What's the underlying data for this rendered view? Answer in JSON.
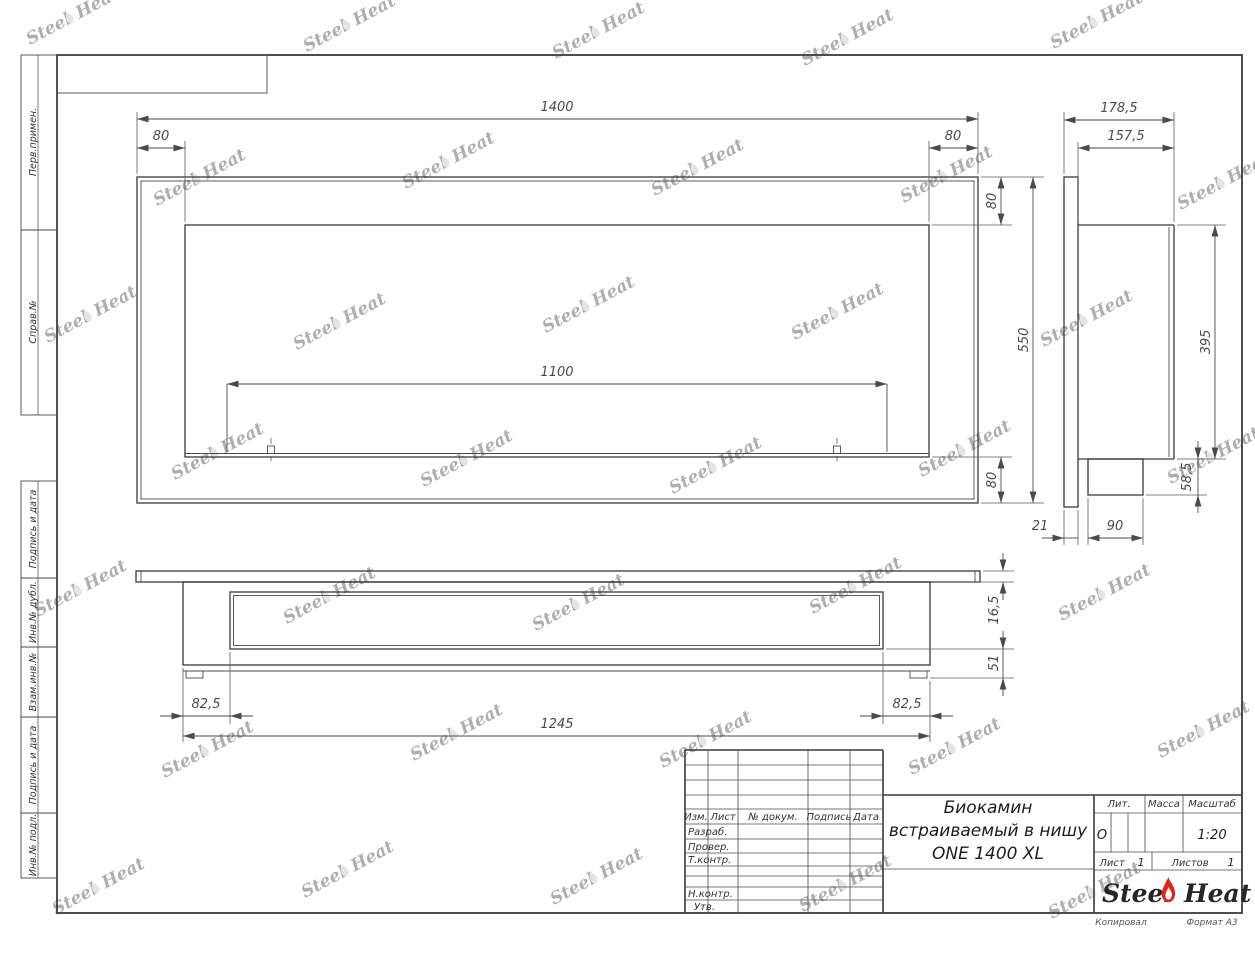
{
  "watermark": {
    "steel": "Steel",
    "heat": "Heat"
  },
  "sidebar": {
    "labels": [
      "Перв.примен.",
      "Справ.№",
      "Подпись и дата",
      "Инв.№ дубл.",
      "Взам.инв.№",
      "Подпись и дата",
      "Инв.№ подл."
    ]
  },
  "dims": {
    "front": {
      "total_width": "1400",
      "left_margin": "80",
      "right_margin": "80",
      "opening_width": "1100",
      "top_margin": "80",
      "total_height": "550",
      "bottom_margin": "80"
    },
    "side": {
      "total_depth": "178,5",
      "inner_depth": "157,5",
      "inner_height": "395",
      "burner_drop": "58,5",
      "flange_offset": "21",
      "burner_depth": "90"
    },
    "plan": {
      "flange_thickness": "16,5",
      "foot_drop": "51",
      "left_offset": "82,5",
      "right_offset": "82,5",
      "body_length": "1245"
    }
  },
  "title_block": {
    "revision_header": [
      "Изм.",
      "Лист",
      "№ докум.",
      "Подпись",
      "Дата"
    ],
    "signature_rows": [
      "Разраб.",
      "Провер.",
      "Т.контр.",
      "",
      "Н.контр.",
      "Утв."
    ],
    "title_line1": "Биокамин",
    "title_line2": "встраиваемый в нишу",
    "title_line3": "ONE 1400 XL",
    "lit_label": "Лит.",
    "mass_label": "Масса",
    "scale_label": "Масштаб",
    "lit_value": "О",
    "scale_value": "1:20",
    "sheet_label": "Лист",
    "sheet_number": "1",
    "sheets_label": "Листов",
    "sheets_total": "1",
    "brand_steel": "Steel",
    "brand_heat": "Heat"
  },
  "footer": {
    "copied": "Копировал",
    "format": "Формат А3"
  },
  "colors": {
    "flame_red": "#e2231a",
    "line": "#3c3c3c",
    "dim_text": "#4a4a4a",
    "watermark": "#cbb9b9"
  }
}
